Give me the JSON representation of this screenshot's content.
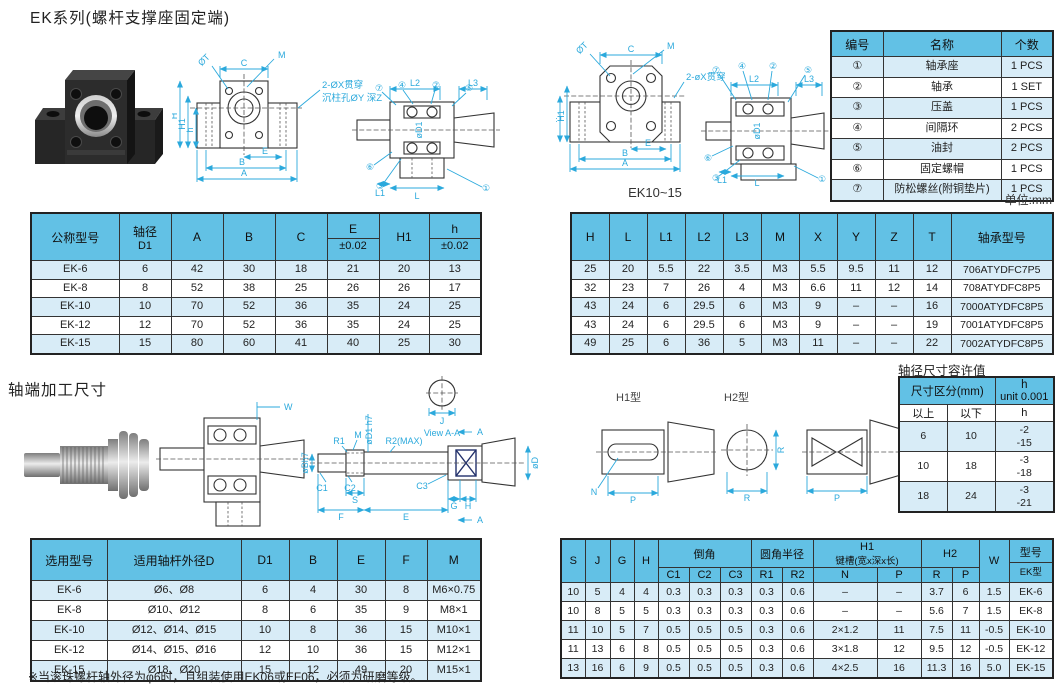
{
  "page": {
    "title": "EK系列(螺杆支撑座固定端)",
    "unit_note": "单位:mm",
    "section2_title": "轴端加工尺寸",
    "tolerance_title": "轴径尺寸容许值",
    "drawing_caption": "EK10~15",
    "footnote": "※当滚珠螺杆轴外径为φ6时，且组装使用EK06或EF06，必须为研磨等级。"
  },
  "colors": {
    "header_blue": "#62C1E5",
    "row_alt": "#D8ECF7",
    "dim_blue": "#2BA9DC",
    "border": "#333333"
  },
  "tables": {
    "parts": {
      "widths": [
        52,
        118,
        52
      ],
      "head": [
        {
          "cells": [
            {
              "t": "编号"
            },
            {
              "t": "名称"
            },
            {
              "t": "个数"
            }
          ]
        }
      ],
      "body": [
        [
          "①",
          "轴承座",
          "1 PCS"
        ],
        [
          "②",
          "轴承",
          "1 SET"
        ],
        [
          "③",
          "压盖",
          "1 PCS"
        ],
        [
          "④",
          "间隔环",
          "2 PCS"
        ],
        [
          "⑤",
          "油封",
          "2 PCS"
        ],
        [
          "⑥",
          "固定螺帽",
          "1 PCS"
        ],
        [
          "⑦",
          "防松螺丝(附铜垫片)",
          "1 PCS"
        ]
      ]
    },
    "dim_left": {
      "widths": [
        88,
        52,
        52,
        52,
        52,
        52,
        50,
        52
      ],
      "head": [
        {
          "cells": [
            {
              "t": "公称型号"
            },
            {
              "t": "轴径",
              "b": "D1"
            },
            {
              "t": "A"
            },
            {
              "t": "B"
            },
            {
              "t": "C"
            },
            {
              "t": "E",
              "b": "±0.02",
              "d": 1
            },
            {
              "t": "H1"
            },
            {
              "t": "h",
              "b": "±0.02",
              "d": 1
            }
          ]
        }
      ],
      "body": [
        [
          "EK-6",
          "6",
          "42",
          "30",
          "18",
          "21",
          "20",
          "13"
        ],
        [
          "EK-8",
          "8",
          "52",
          "38",
          "25",
          "26",
          "26",
          "17"
        ],
        [
          "EK-10",
          "10",
          "70",
          "52",
          "36",
          "35",
          "24",
          "25"
        ],
        [
          "EK-12",
          "12",
          "70",
          "52",
          "36",
          "35",
          "24",
          "25"
        ],
        [
          "EK-15",
          "15",
          "80",
          "60",
          "41",
          "40",
          "25",
          "30"
        ]
      ]
    },
    "dim_right": {
      "widths": [
        38,
        38,
        38,
        38,
        38,
        38,
        38,
        38,
        38,
        38,
        102
      ],
      "head": [
        {
          "cells": [
            {
              "t": "H"
            },
            {
              "t": "L"
            },
            {
              "t": "L1"
            },
            {
              "t": "L2"
            },
            {
              "t": "L3"
            },
            {
              "t": "M"
            },
            {
              "t": "X"
            },
            {
              "t": "Y"
            },
            {
              "t": "Z"
            },
            {
              "t": "T"
            },
            {
              "t": "轴承型号"
            }
          ]
        }
      ],
      "body": [
        [
          "25",
          "20",
          "5.5",
          "22",
          "3.5",
          "M3",
          "5.5",
          "9.5",
          "11",
          "12",
          "706ATYDFC7P5"
        ],
        [
          "32",
          "23",
          "7",
          "26",
          "4",
          "M3",
          "6.6",
          "11",
          "12",
          "14",
          "708ATYDFC8P5"
        ],
        [
          "43",
          "24",
          "6",
          "29.5",
          "6",
          "M3",
          "9",
          "–",
          "–",
          "16",
          "7000ATYDFC8P5"
        ],
        [
          "43",
          "24",
          "6",
          "29.5",
          "6",
          "M3",
          "9",
          "–",
          "–",
          "19",
          "7001ATYDFC8P5"
        ],
        [
          "49",
          "25",
          "6",
          "36",
          "5",
          "M3",
          "11",
          "–",
          "–",
          "22",
          "7002ATYDFC8P5"
        ]
      ]
    },
    "tolerance": {
      "widths": [
        48,
        48,
        59
      ],
      "head": [
        {
          "cells": [
            {
              "t": "尺寸区分(mm)",
              "c": 2
            },
            {
              "t": "h",
              "b": "unit 0.001"
            }
          ]
        },
        {
          "cls": "white",
          "cells": [
            {
              "t": "以上"
            },
            {
              "t": "以下"
            },
            {
              "t": "h"
            }
          ]
        }
      ],
      "body": [
        [
          "6",
          "10",
          "-2\n-15"
        ],
        [
          "10",
          "18",
          "-3\n-18"
        ],
        [
          "18",
          "24",
          "-3\n-21"
        ]
      ]
    },
    "select": {
      "widths": [
        76,
        134,
        48,
        48,
        48,
        42,
        54
      ],
      "head": [
        {
          "cells": [
            {
              "t": "选用型号"
            },
            {
              "t": "适用轴杆外径D"
            },
            {
              "t": "D1"
            },
            {
              "t": "B"
            },
            {
              "t": "E"
            },
            {
              "t": "F"
            },
            {
              "t": "M"
            }
          ]
        }
      ],
      "body": [
        [
          "EK-6",
          "Ø6、Ø8",
          "6",
          "4",
          "30",
          "8",
          "M6×0.75"
        ],
        [
          "EK-8",
          "Ø10、Ø12",
          "8",
          "6",
          "35",
          "9",
          "M8×1"
        ],
        [
          "EK-10",
          "Ø12、Ø14、Ø15",
          "10",
          "8",
          "36",
          "15",
          "M10×1"
        ],
        [
          "EK-12",
          "Ø14、Ø15、Ø16",
          "12",
          "10",
          "36",
          "15",
          "M12×1"
        ],
        [
          "EK-15",
          "Ø18、Ø20",
          "15",
          "12",
          "49",
          "20",
          "M15×1"
        ]
      ]
    },
    "shaft": {
      "widths": [
        24,
        25,
        24,
        24,
        31,
        31,
        31,
        31,
        31,
        64,
        44,
        31,
        27,
        30,
        44
      ],
      "head": [
        {
          "cells": [
            {
              "t": "S",
              "r": 2
            },
            {
              "t": "J",
              "r": 2
            },
            {
              "t": "G",
              "r": 2
            },
            {
              "t": "H",
              "r": 2
            },
            {
              "t": "倒角",
              "c": 3
            },
            {
              "t": "圆角半径",
              "c": 2
            },
            {
              "t": "H1",
              "b": "键槽(宽x深x长)",
              "c": 2
            },
            {
              "t": "H2",
              "c": 2
            },
            {
              "t": "W",
              "r": 2
            },
            {
              "t": "型号",
              "b": "EK型",
              "d": 1,
              "r": 2
            }
          ]
        },
        {
          "cells": [
            {
              "t": "C1"
            },
            {
              "t": "C2"
            },
            {
              "t": "C3"
            },
            {
              "t": "R1"
            },
            {
              "t": "R2"
            },
            {
              "t": "N"
            },
            {
              "t": "P"
            },
            {
              "t": "R"
            },
            {
              "t": "P"
            }
          ]
        }
      ],
      "body": [
        [
          "10",
          "5",
          "4",
          "4",
          "0.3",
          "0.3",
          "0.3",
          "0.3",
          "0.6",
          "–",
          "–",
          "3.7",
          "6",
          "1.5",
          "EK-6"
        ],
        [
          "10",
          "8",
          "5",
          "5",
          "0.3",
          "0.3",
          "0.3",
          "0.3",
          "0.6",
          "–",
          "–",
          "5.6",
          "7",
          "1.5",
          "EK-8"
        ],
        [
          "11",
          "10",
          "5",
          "7",
          "0.5",
          "0.5",
          "0.5",
          "0.3",
          "0.6",
          "2×1.2",
          "11",
          "7.5",
          "11",
          "-0.5",
          "EK-10"
        ],
        [
          "11",
          "13",
          "6",
          "8",
          "0.5",
          "0.5",
          "0.5",
          "0.3",
          "0.6",
          "3×1.8",
          "12",
          "9.5",
          "12",
          "-0.5",
          "EK-12"
        ],
        [
          "13",
          "16",
          "6",
          "9",
          "0.5",
          "0.5",
          "0.5",
          "0.3",
          "0.6",
          "4×2.5",
          "16",
          "11.3",
          "16",
          "5.0",
          "EK-15"
        ]
      ]
    }
  },
  "drawings": {
    "front1": {
      "labels": {
        "dt": "ØT",
        "c": "C",
        "m": "M",
        "note1": "2-ØX贯穿",
        "note2": "沉柱孔ØY 深Z",
        "h": "H",
        "h1": "H1",
        "hs": "h",
        "e": "E",
        "b": "B",
        "a": "A"
      }
    },
    "side1": {
      "labels": {
        "l2": "L2",
        "l3": "L3",
        "l1": "L1",
        "l": "L",
        "d1": "øD1",
        "n7": "⑦",
        "n4": "④",
        "n2": "②",
        "n5": "⑤",
        "n6": "⑥",
        "n3": "③",
        "n1": "①"
      }
    },
    "front2": {
      "labels": {
        "dt": "ØT",
        "c": "C",
        "m": "M",
        "note1": "2-øX贯穿",
        "hs": "h",
        "h1": "H1",
        "e": "E",
        "b": "B",
        "a": "A"
      }
    },
    "side2": {
      "labels": {
        "l2": "L2",
        "l3": "L3",
        "l1": "L1",
        "l": "L",
        "d1": "øD1",
        "n7": "⑦",
        "n4": "④",
        "n2": "②",
        "n5": "⑤",
        "n6": "⑥",
        "n3": "③",
        "n1": "①"
      }
    },
    "crosssec": {
      "labels": {
        "w": "W"
      }
    },
    "shaftdim": {
      "labels": {
        "bh7": "øBh7",
        "c1": "C1",
        "r1": "R1",
        "c2": "C2",
        "m": "M",
        "s": "S",
        "d1h7": "øD1 h7",
        "r2": "R2(MAX)",
        "c3": "C3",
        "f": "F",
        "e": "E",
        "g": "G",
        "h": "H",
        "dd": "øD",
        "view": "View A-A",
        "a_top": "A",
        "a_bot": "A",
        "j": "J"
      }
    },
    "h1type": {
      "title": "H1型",
      "labels": {
        "n": "N",
        "p": "P"
      }
    },
    "h2type": {
      "title": "H2型",
      "labels": {
        "r_v": "R",
        "r": "R",
        "p": "P"
      }
    }
  }
}
